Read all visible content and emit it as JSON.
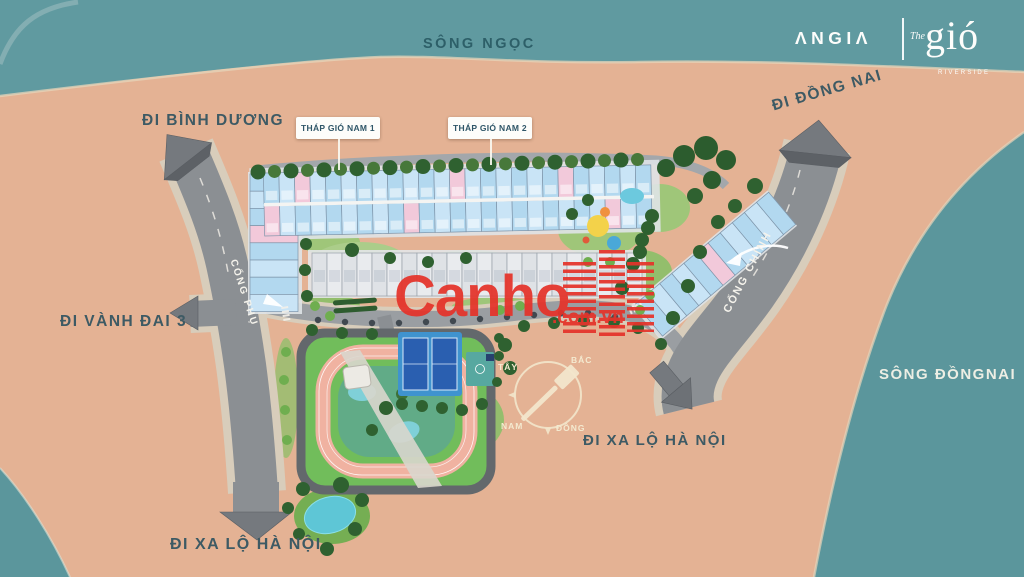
{
  "brand": {
    "company_logo": "ΛNGIΛ",
    "project_the": "The",
    "project_name": "gió",
    "project_subtitle": "RIVERSIDE"
  },
  "rivers": {
    "top": "SÔNG NGỌC",
    "right": "SÔNG ĐỒNGNAI"
  },
  "directions": {
    "binh_duong": "ĐI BÌNH DƯƠNG",
    "dong_nai": "ĐI ĐỒNG NAI",
    "vanh_dai_3": "ĐI VÀNH ĐAI 3",
    "xa_lo_ha_noi_east": "ĐI XA LỘ HÀ NỘI",
    "xa_lo_ha_noi_south": "ĐI XA LỘ HÀ NỘI"
  },
  "gates": {
    "secondary": "CỔNG PHỤ",
    "main": "CỔNG CHÍNH"
  },
  "towers": [
    {
      "label": "THÁP GIÓ NAM 1"
    },
    {
      "label": "THÁP GIÓ NAM 2"
    }
  ],
  "compass": {
    "north": "BẮC",
    "south": "NAM",
    "east": "ĐÔNG",
    "west": "TÂY"
  },
  "watermark": {
    "name": "Canho",
    "suffix": ".com.vn"
  },
  "colors": {
    "land": "#e4b294",
    "river": "#609aa0",
    "road": "#8b8f93",
    "building_blue": "#b2d8ef",
    "building_pink": "#f2c9da",
    "park_green": "#9cc878",
    "track_pink": "#f0b2a1",
    "court_blue": "#2a5fb0",
    "watermark_red": "#e5332a",
    "label_dark": "#3d5a64",
    "label_light": "#edeee4"
  }
}
